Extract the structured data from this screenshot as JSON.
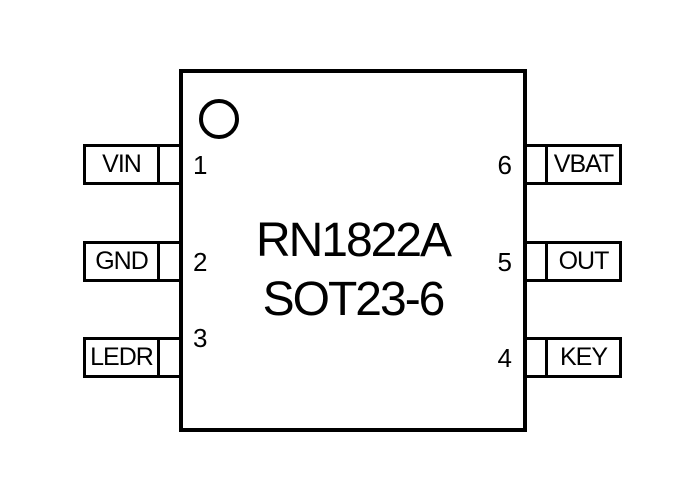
{
  "chip": {
    "part_number": "RN1822A",
    "package": "SOT23-6"
  },
  "pins": [
    {
      "number": "1",
      "label": "VIN",
      "side": "left"
    },
    {
      "number": "2",
      "label": "GND",
      "side": "left"
    },
    {
      "number": "3",
      "label": "LEDR",
      "side": "left"
    },
    {
      "number": "4",
      "label": "KEY",
      "side": "right"
    },
    {
      "number": "5",
      "label": "OUT",
      "side": "right"
    },
    {
      "number": "6",
      "label": "VBAT",
      "side": "right"
    }
  ],
  "colors": {
    "line": "#000000",
    "text": "#000000",
    "background": "#ffffff"
  }
}
